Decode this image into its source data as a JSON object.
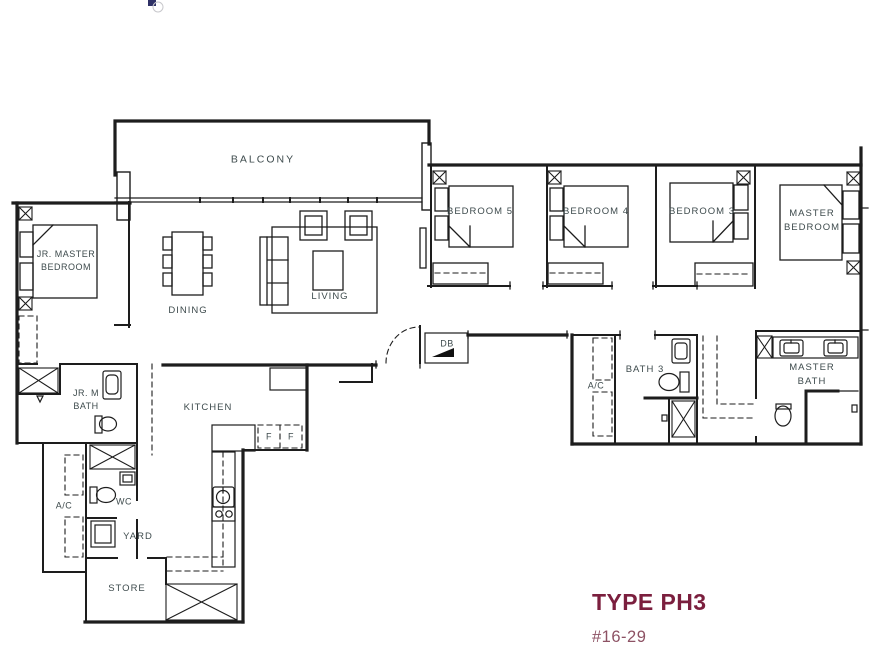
{
  "plan": {
    "title": "TYPE PH3",
    "unit": "#16-29",
    "rooms": {
      "balcony": "BALCONY",
      "dining": "DINING",
      "living": "LIVING",
      "bedroom5": "BEDROOM 5",
      "bedroom4": "BEDROOM 4",
      "bedroom3": "BEDROOM 3",
      "master_bedroom": "MASTER\nBEDROOM",
      "jr_master_bedroom": "JR. MASTER\nBEDROOM",
      "jr_m_bath": "JR. M\nBATH",
      "master_bath": "MASTER\nBATH",
      "bath3": "BATH 3",
      "kitchen": "KITCHEN",
      "db": "DB",
      "ac": "A/C",
      "wc": "WC",
      "yard": "YARD",
      "store": "STORE",
      "fridge": "F",
      "door_marker": "D"
    },
    "colors": {
      "line": "#1d1d1d",
      "label": "#3e4b4d",
      "accent": "#7b1f3e",
      "accent_muted": "#8d5264"
    }
  }
}
